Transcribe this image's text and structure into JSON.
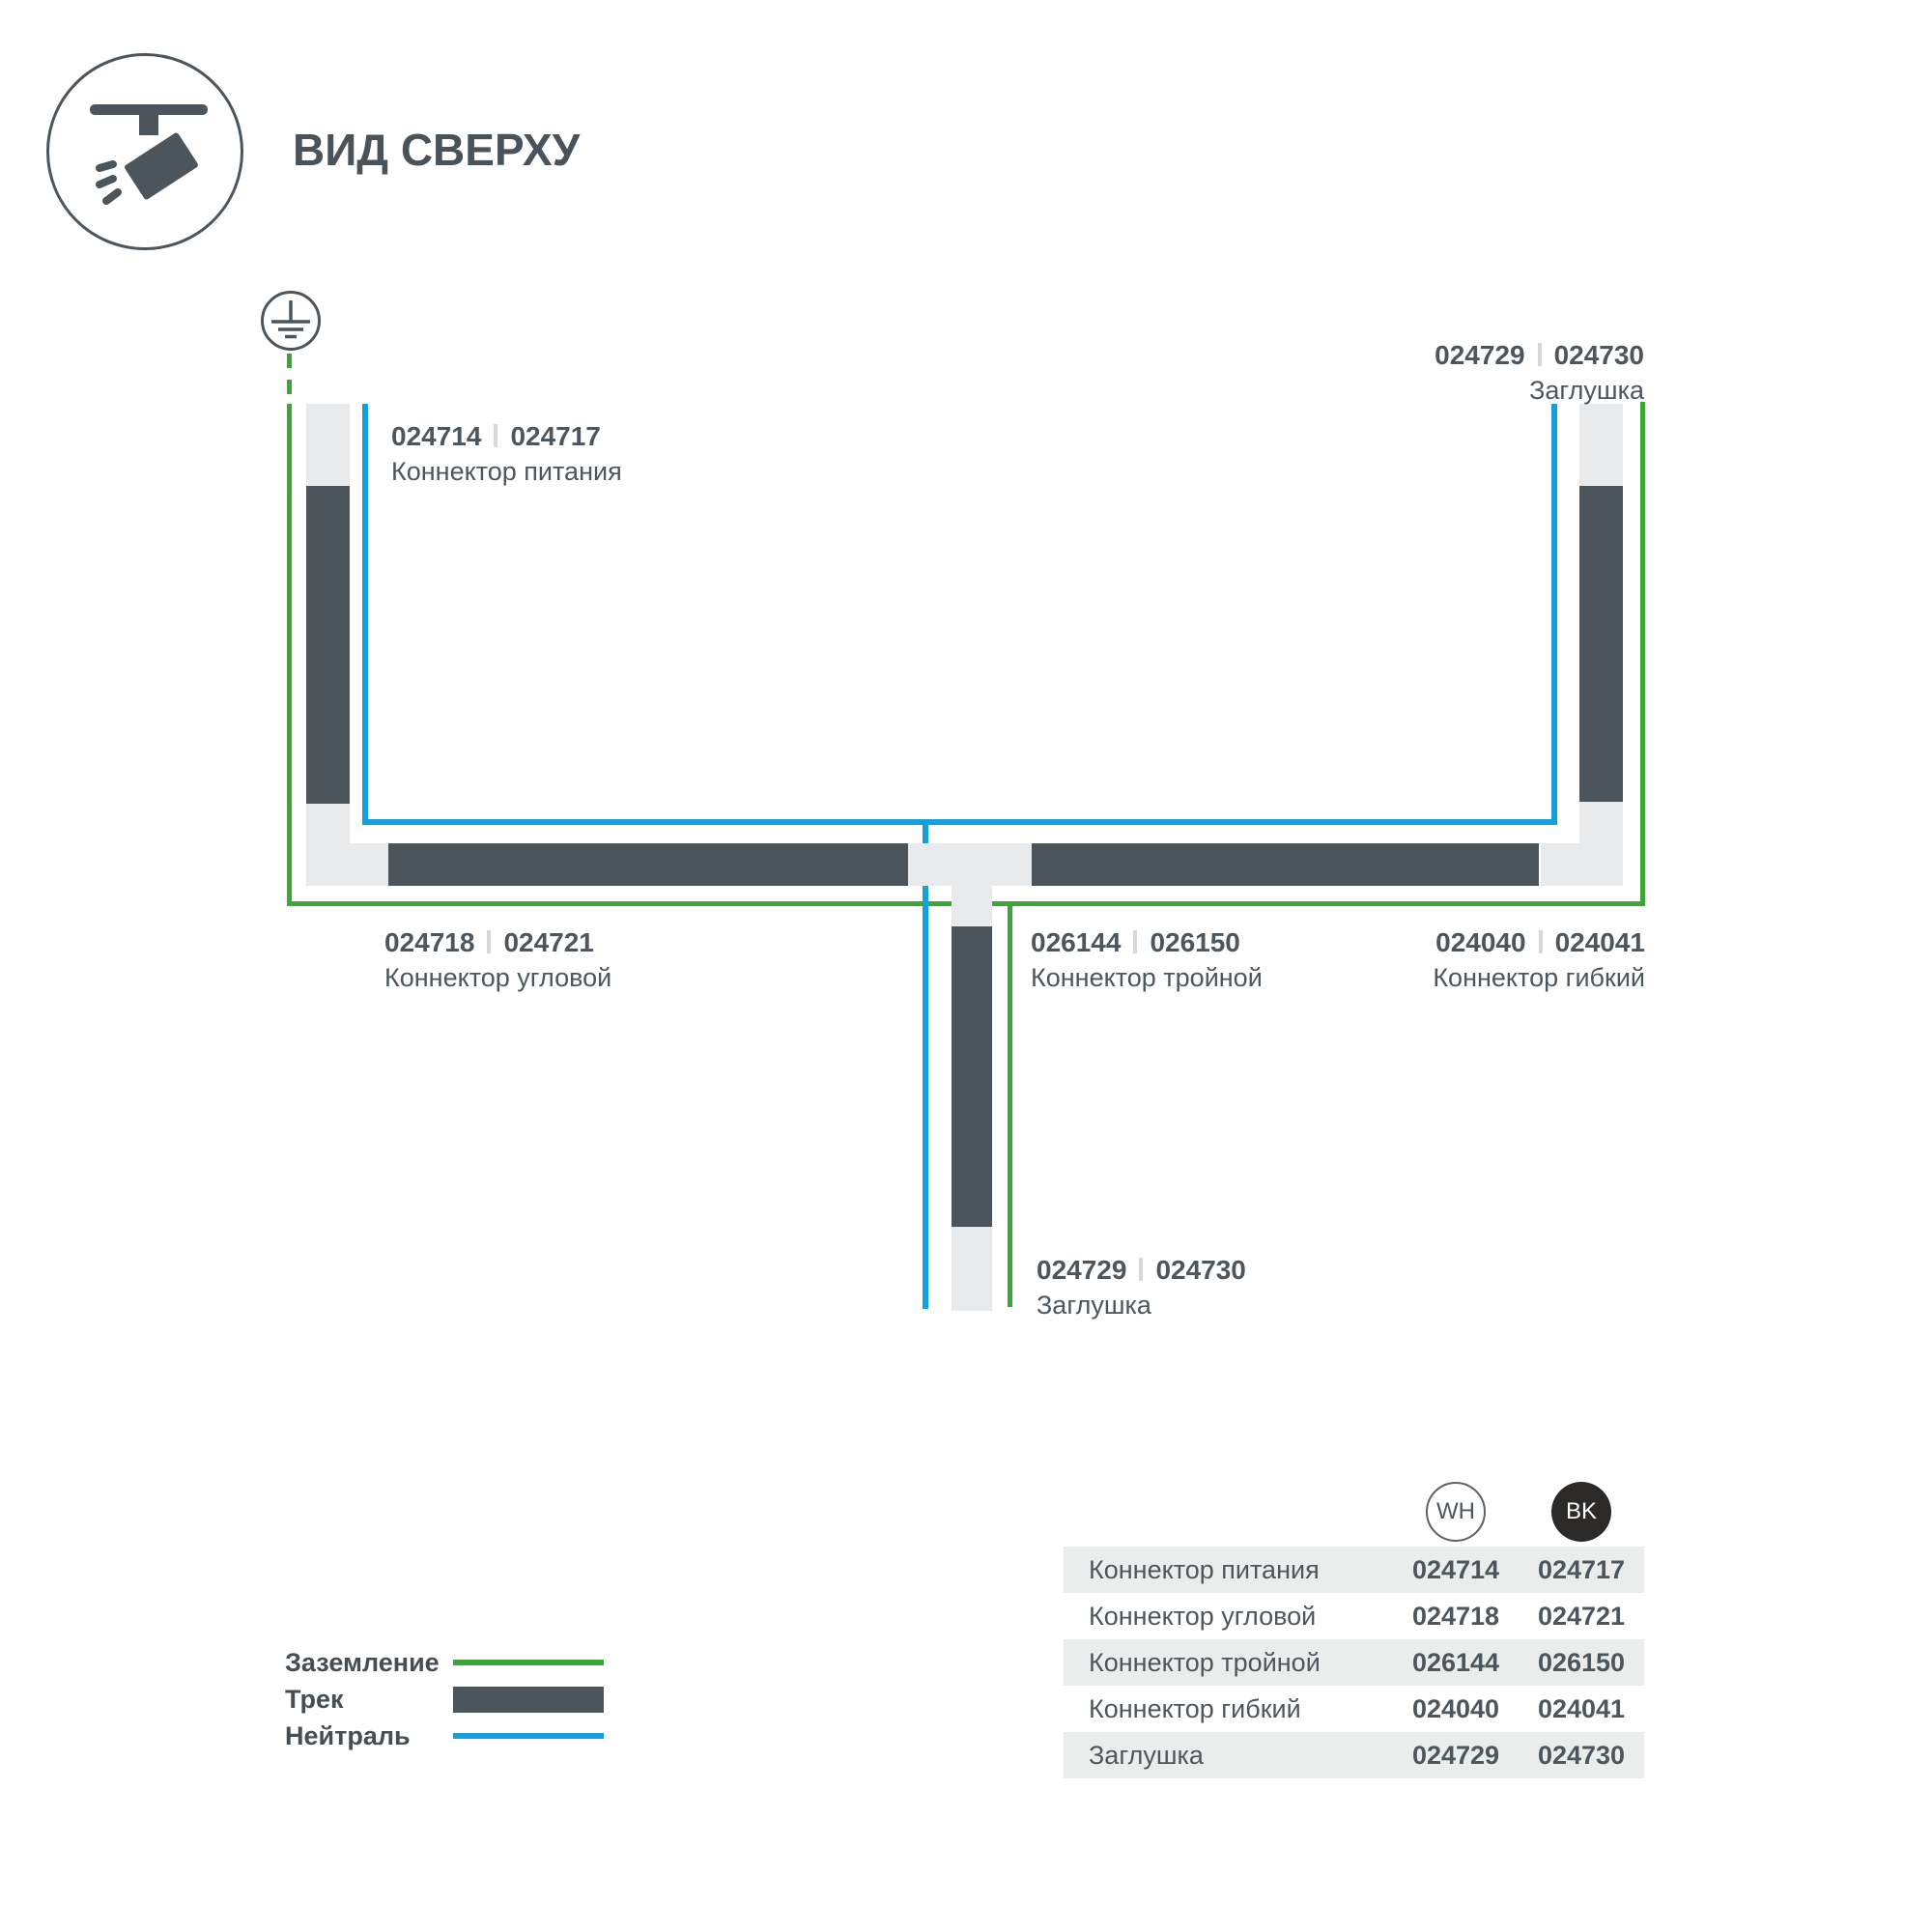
{
  "header": {
    "title": "ВИД СВЕРХУ"
  },
  "diagram": {
    "ground_symbol": "earth-ground",
    "callouts": [
      {
        "wh": "024714",
        "bk": "024717",
        "name": "Коннектор питания"
      },
      {
        "wh": "024729",
        "bk": "024730",
        "name": "Заглушка"
      },
      {
        "wh": "024718",
        "bk": "024721",
        "name": "Коннектор угловой"
      },
      {
        "wh": "026144",
        "bk": "026150",
        "name": "Коннектор тройной"
      },
      {
        "wh": "024040",
        "bk": "024041",
        "name": "Коннектор гибкий"
      },
      {
        "wh": "024729",
        "bk": "024730",
        "name": "Заглушка"
      }
    ]
  },
  "legend": {
    "items": [
      {
        "label": "Заземление",
        "type": "ground-line"
      },
      {
        "label": "Трек",
        "type": "track-bar"
      },
      {
        "label": "Нейтраль",
        "type": "neutral-line"
      }
    ]
  },
  "table": {
    "columns": [
      {
        "code": "WH"
      },
      {
        "code": "BK"
      }
    ],
    "rows": [
      {
        "label": "Коннектор питания",
        "wh": "024714",
        "bk": "024717"
      },
      {
        "label": "Коннектор угловой",
        "wh": "024718",
        "bk": "024721"
      },
      {
        "label": "Коннектор тройной",
        "wh": "026144",
        "bk": "026150"
      },
      {
        "label": "Коннектор гибкий",
        "wh": "024040",
        "bk": "024041"
      },
      {
        "label": "Заглушка",
        "wh": "024729",
        "bk": "024730"
      }
    ]
  },
  "colors": {
    "ground_green": "#3DA639",
    "neutral_blue": "#14A0DC",
    "track_dark": "#4C555C",
    "track_light": "#E9EAEB",
    "text": "#4D565C",
    "table_stripe": "#EBECEC",
    "bk_circle": "#2B2A29"
  }
}
